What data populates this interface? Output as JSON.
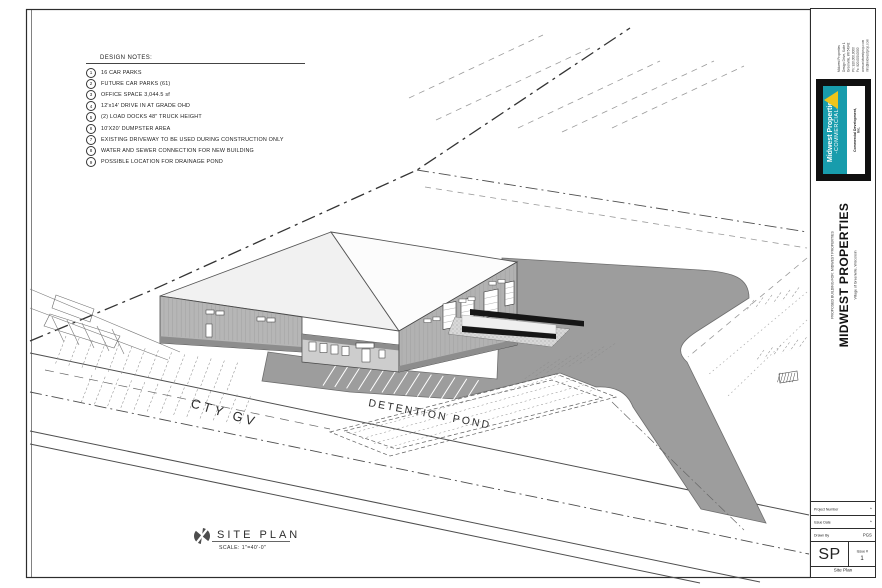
{
  "sheet": {
    "design_notes": {
      "title": "DESIGN NOTES:",
      "items": [
        {
          "num": "1",
          "text": "16 CAR PARKS"
        },
        {
          "num": "2",
          "text": "FUTURE CAR PARKS (61)"
        },
        {
          "num": "3",
          "text": "OFFICE SPACE 3,044.5 sf"
        },
        {
          "num": "4",
          "text": "12'x14' DRIVE IN AT GRADE OHD"
        },
        {
          "num": "5",
          "text": "(2) LOAD DOCKS 48\" TRUCK HEIGHT"
        },
        {
          "num": "6",
          "text": "10'X20' DUMPSTER AREA"
        },
        {
          "num": "7",
          "text": "EXISTING DRIVEWAY TO BE USED DURING CONSTRUCTION ONLY"
        },
        {
          "num": "8",
          "text": "WATER AND SEWER CONNECTION FOR NEW BUILDING"
        },
        {
          "num": "9",
          "text": "POSSIBLE LOCATION FOR DRAINAGE POND"
        }
      ]
    },
    "labels": {
      "road": "CTY GV",
      "pond": "DETENTION POND"
    },
    "view_title": {
      "name": "SITE PLAN",
      "scale": "SCALE: 1\"=40'-0\""
    }
  },
  "titleblock": {
    "address_lines": [
      "Midwest Properties",
      "Design Drive, Suite 1",
      "Greenville, WI 54942",
      "Ph: 920.000.0000",
      "Fx: 920.000.0000",
      "www.midwestprop.com",
      "info@midwestprop.com"
    ],
    "logo": {
      "line1": "Midwest Properties",
      "line2": "-COMMERCIAL-",
      "tagline": "Commercial Development, Inc."
    },
    "project": {
      "label": "PROPOSED BUILDING FOR:  MIDWEST PROPERTIES",
      "name": "MIDWEST PROPERTIES",
      "location": "Village of Greenville,  Wisconsin"
    },
    "rev_rows": [
      "Revisions",
      "Date",
      "Issue"
    ],
    "fields": [
      {
        "label": "Project Number",
        "value": "*"
      },
      {
        "label": "Issue Date",
        "value": "*"
      },
      {
        "label": "Drawn By",
        "value": "PGS"
      }
    ],
    "sheet_code": "SP",
    "issue_label": "Issue #",
    "issue_value": "1",
    "sheet_name": "Site Plan"
  }
}
